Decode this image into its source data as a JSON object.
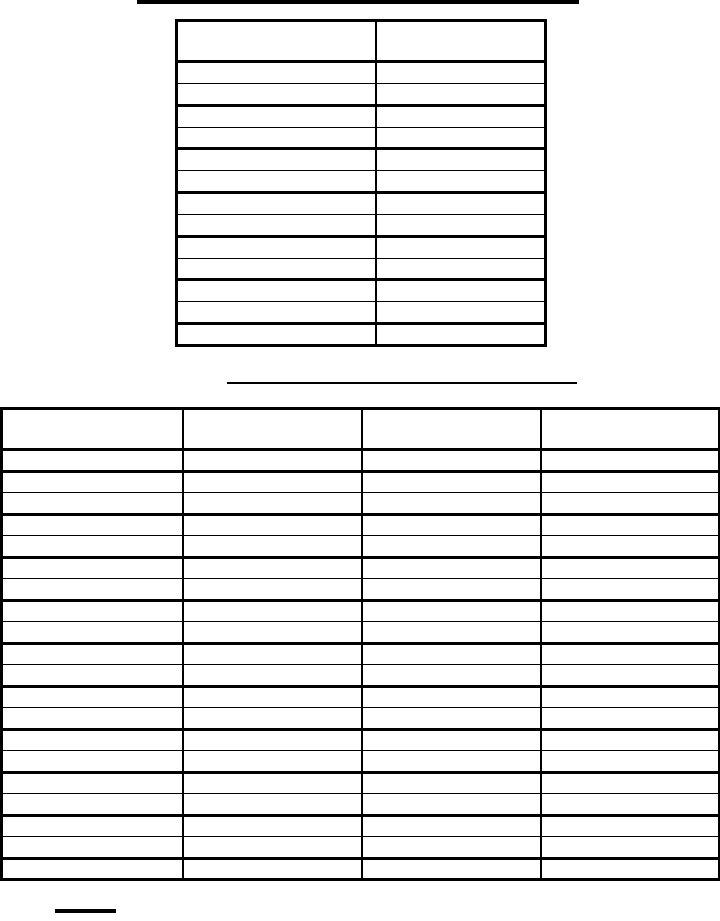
{
  "colors": {
    "ink": "#000000",
    "paper": "#ffffff"
  },
  "top_title": {
    "text": ""
  },
  "middle_title": {
    "text": ""
  },
  "footnote": {
    "text": ""
  },
  "table1": {
    "header": [
      "",
      ""
    ],
    "rows": [
      [
        "",
        ""
      ],
      [
        "",
        ""
      ],
      [
        "",
        ""
      ],
      [
        "",
        ""
      ],
      [
        "",
        ""
      ],
      [
        "",
        ""
      ],
      [
        "",
        ""
      ],
      [
        "",
        ""
      ],
      [
        "",
        ""
      ],
      [
        "",
        ""
      ],
      [
        "",
        ""
      ],
      [
        "",
        ""
      ],
      [
        "",
        ""
      ]
    ]
  },
  "table2": {
    "header": [
      "",
      "",
      "",
      ""
    ],
    "rows": [
      [
        "",
        "",
        "",
        ""
      ],
      [
        "",
        "",
        "",
        ""
      ],
      [
        "",
        "",
        "",
        ""
      ],
      [
        "",
        "",
        "",
        ""
      ],
      [
        "",
        "",
        "",
        ""
      ],
      [
        "",
        "",
        "",
        ""
      ],
      [
        "",
        "",
        "",
        ""
      ],
      [
        "",
        "",
        "",
        ""
      ],
      [
        "",
        "",
        "",
        ""
      ],
      [
        "",
        "",
        "",
        ""
      ],
      [
        "",
        "",
        "",
        ""
      ],
      [
        "",
        "",
        "",
        ""
      ],
      [
        "",
        "",
        "",
        ""
      ],
      [
        "",
        "",
        "",
        ""
      ],
      [
        "",
        "",
        "",
        ""
      ],
      [
        "",
        "",
        "",
        ""
      ],
      [
        "",
        "",
        "",
        ""
      ],
      [
        "",
        "",
        "",
        ""
      ],
      [
        "",
        "",
        "",
        ""
      ],
      [
        "",
        "",
        "",
        ""
      ]
    ]
  }
}
